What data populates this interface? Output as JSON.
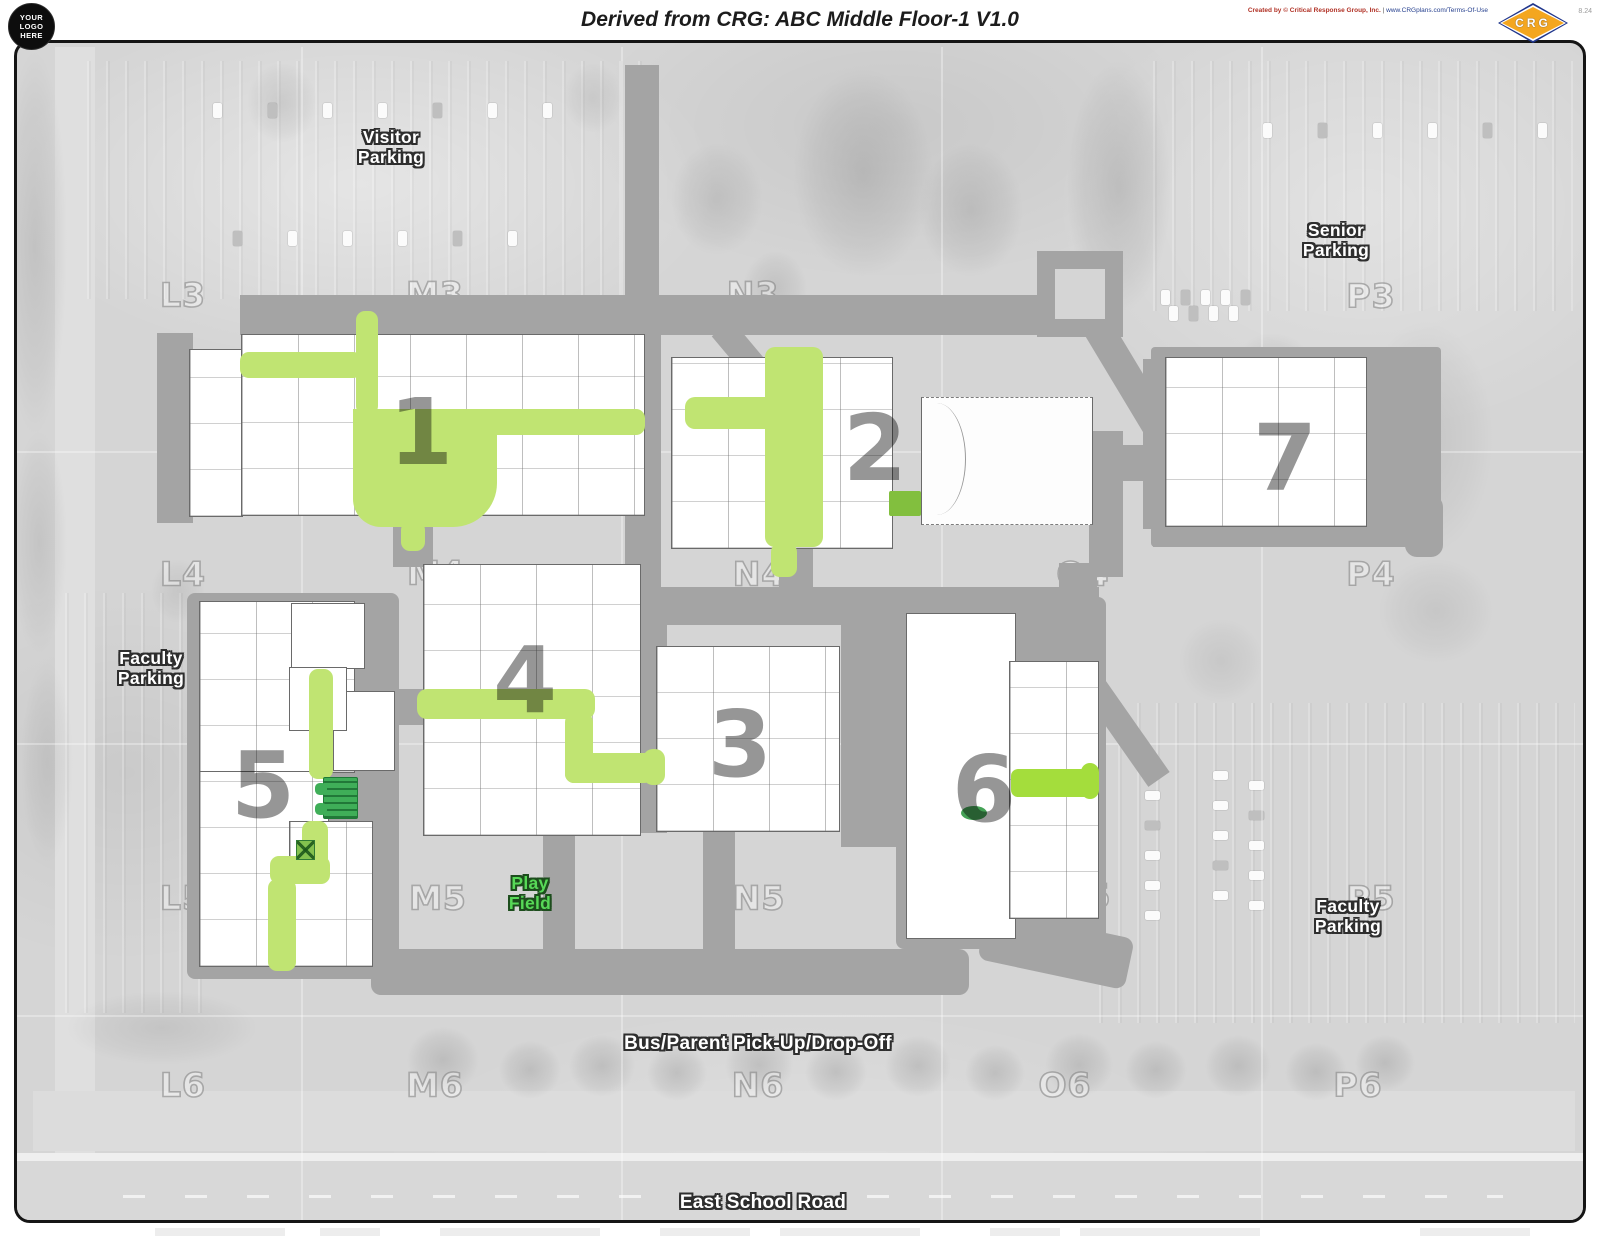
{
  "header": {
    "logo": {
      "line1": "YOUR",
      "line2": "LOGO",
      "line3": "HERE"
    },
    "title": "Derived from CRG: ABC Middle Floor-1 V1.0",
    "credit": {
      "created": "Created by © Critical Response Group, Inc.",
      "separator": " | ",
      "link": "www.CRGplans.com/Terms-Of-Use"
    },
    "version": "8.24",
    "crg_logo_text": "CRG"
  },
  "map": {
    "floor_name": "ABC Middle Floor-1",
    "grid_labels": [
      {
        "label": "L3",
        "x": 180,
        "y": 292
      },
      {
        "label": "M3",
        "x": 432,
        "y": 291
      },
      {
        "label": "N3",
        "x": 750,
        "y": 291
      },
      {
        "label": "O3",
        "x": 1080,
        "y": 293
      },
      {
        "label": "P3",
        "x": 1368,
        "y": 293
      },
      {
        "label": "L4",
        "x": 180,
        "y": 571
      },
      {
        "label": "M4",
        "x": 433,
        "y": 570
      },
      {
        "label": "N4",
        "x": 756,
        "y": 571
      },
      {
        "label": "O4",
        "x": 1080,
        "y": 571
      },
      {
        "label": "P4",
        "x": 1368,
        "y": 571
      },
      {
        "label": "L5",
        "x": 180,
        "y": 895
      },
      {
        "label": "M5",
        "x": 435,
        "y": 895
      },
      {
        "label": "N5",
        "x": 756,
        "y": 895
      },
      {
        "label": "O5",
        "x": 1082,
        "y": 893
      },
      {
        "label": "P5",
        "x": 1368,
        "y": 895
      },
      {
        "label": "L6",
        "x": 180,
        "y": 1082
      },
      {
        "label": "M6",
        "x": 432,
        "y": 1082
      },
      {
        "label": "N6",
        "x": 755,
        "y": 1082
      },
      {
        "label": "O6",
        "x": 1062,
        "y": 1082
      },
      {
        "label": "P6",
        "x": 1355,
        "y": 1082
      }
    ],
    "buildings": [
      {
        "number": "1",
        "x": 418,
        "y": 430
      },
      {
        "number": "2",
        "x": 872,
        "y": 446
      },
      {
        "number": "3",
        "x": 737,
        "y": 742
      },
      {
        "number": "4",
        "x": 522,
        "y": 678
      },
      {
        "number": "5",
        "x": 260,
        "y": 783
      },
      {
        "number": "6",
        "x": 981,
        "y": 787
      },
      {
        "number": "7",
        "x": 1282,
        "y": 456
      }
    ],
    "area_labels": [
      {
        "id": "visitor-parking",
        "type": "parking",
        "x": 388,
        "y": 145,
        "lines": [
          "Visitor",
          "Parking"
        ]
      },
      {
        "id": "senior-parking",
        "type": "parking",
        "x": 1333,
        "y": 238,
        "lines": [
          "Senior",
          "Parking"
        ]
      },
      {
        "id": "faculty-parking-west",
        "type": "parking",
        "x": 148,
        "y": 666,
        "lines": [
          "Faculty",
          "Parking"
        ]
      },
      {
        "id": "play-field",
        "type": "field",
        "x": 527,
        "y": 891,
        "lines": [
          "Play",
          "Field"
        ]
      },
      {
        "id": "faculty-parking-east",
        "type": "parking",
        "x": 1345,
        "y": 914,
        "lines": [
          "Faculty",
          "Parking"
        ]
      },
      {
        "id": "bus-parent-pick-up-drop-off",
        "type": "road",
        "x": 755,
        "y": 1041,
        "lines": [
          "Bus/Parent Pick-Up/Drop-Off"
        ]
      },
      {
        "id": "east-school-road",
        "type": "road",
        "x": 760,
        "y": 1200,
        "lines": [
          "East School Road"
        ]
      }
    ],
    "colors": {
      "route_green": "#c0e472",
      "bright_green": "#a4dd3c",
      "stair_green": "#3fae58",
      "corridor_gray": "#a4a4a4",
      "building_white": "#ffffff",
      "map_background": "#d5d5d5"
    }
  }
}
